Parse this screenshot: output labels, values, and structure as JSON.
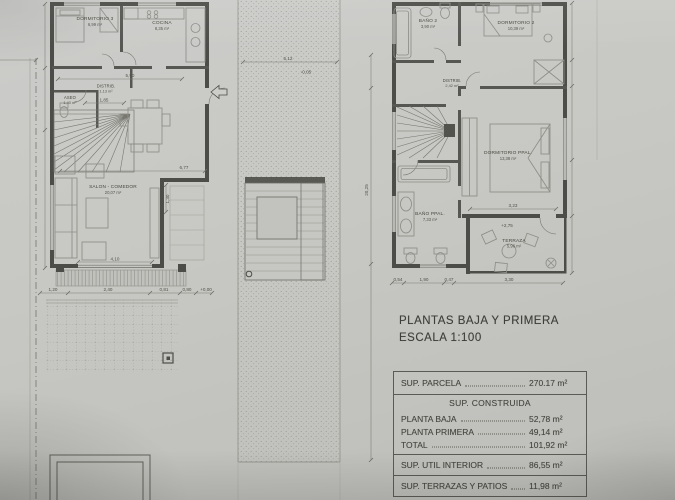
{
  "title": {
    "line1": "PLANTAS BAJA Y PRIMERA",
    "line2": "ESCALA  1:100"
  },
  "areas_table": {
    "parcela": {
      "label": "SUP. PARCELA",
      "value": "270.17 m²"
    },
    "construida": {
      "header": "SUP. CONSTRUIDA",
      "rows": [
        {
          "label": "PLANTA  BAJA",
          "value": "52,78 m²"
        },
        {
          "label": "PLANTA  PRIMERA",
          "value": "49,14 m²"
        },
        {
          "label": "TOTAL",
          "value": "101,92 m²"
        }
      ]
    },
    "util": {
      "label": "SUP. UTIL INTERIOR",
      "value": "86,55 m²"
    },
    "terrazas": {
      "label": "SUP. TERRAZAS Y PATIOS",
      "value": "11,98 m²"
    }
  },
  "ground_floor": {
    "rooms": {
      "dormitorio3": {
        "name": "DORMITORIO 3",
        "area": "6,99 m²"
      },
      "cocina": {
        "name": "COCINA",
        "area": "8,35 m²"
      },
      "distrib": {
        "name": "DISTRIB.",
        "area": "1,13 m²"
      },
      "aseo": {
        "name": "ASEO",
        "area": "1,40 m²"
      },
      "salon": {
        "name": "SALON - COMEDOR",
        "area": "20,07 m²"
      }
    },
    "dims": {
      "width_top": "5,90",
      "hall": "1,85",
      "rear": "6,77",
      "jog": "1,30",
      "door": "4,10",
      "site_row": [
        "1,20",
        "2,40",
        "0,81",
        "0,80",
        "+0,00"
      ]
    }
  },
  "first_floor": {
    "rooms": {
      "bano2": {
        "name": "BAÑO 2",
        "area": "3,90 m²"
      },
      "dormitorio2": {
        "name": "DORMITORIO 2",
        "area": "10,39 m²"
      },
      "distrib": {
        "name": "DISTRIB.",
        "area": "2,42 m²"
      },
      "dormitorio_ppal": {
        "name": "DORMITORIO PPAL.",
        "area": "13,38 m²"
      },
      "bano_ppal": {
        "name": "BAÑO PPAL.",
        "area": "7,33 m²"
      },
      "terraza": {
        "name": "TERRAZA",
        "area": "5,96 m²"
      }
    },
    "dims": {
      "bed_width": "3,23",
      "bottom_row": [
        "0,54",
        "1,90",
        "0,47",
        "3,30"
      ],
      "terraza_level": "+2,75"
    }
  },
  "site": {
    "patio_width": "5,12",
    "patio_level": "-0,05",
    "plot_depth": "20,25"
  }
}
